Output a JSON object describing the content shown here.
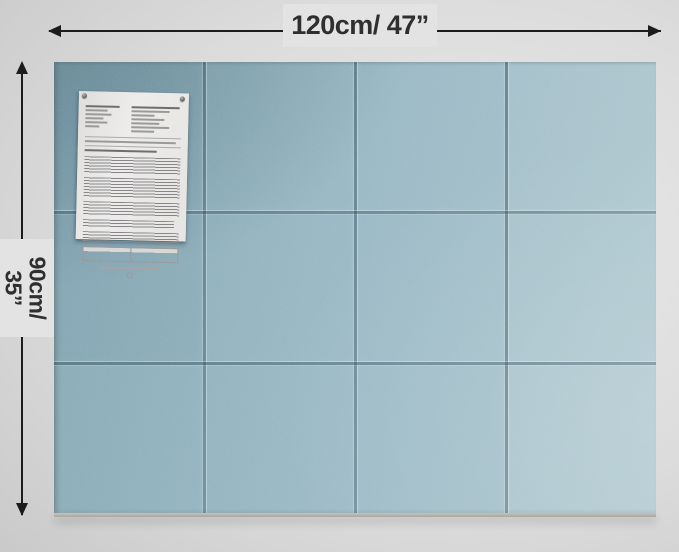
{
  "meta": {
    "type": "product-photo",
    "subject": "light blue felt pin-board made of 12 square tiles (4 columns x 3 rows) mounted on a gray wall, with an instruction sheet pinned to the top-left tile and dimension arrows"
  },
  "dimensions": {
    "width_label": "120cm/ 47”",
    "height_label": {
      "line1": "90cm/",
      "line2": "35”"
    }
  },
  "board": {
    "rows": 3,
    "columns": 4,
    "tile_count": 12
  },
  "paper": {
    "pins": [
      "top-left",
      "top-right"
    ],
    "legible_text": false
  },
  "colors": {
    "arrow": "#1c1c1c",
    "label-bg": "#e3e3e3",
    "label-text": "#2f2f2f",
    "board-dark": "#7ba0ae",
    "board-mid": "#8fb1be",
    "board-light": "#a6c2cb",
    "paper": "#ebeae6",
    "wall-light": "#eaeaea",
    "wall-dark": "#c8c8c8"
  }
}
